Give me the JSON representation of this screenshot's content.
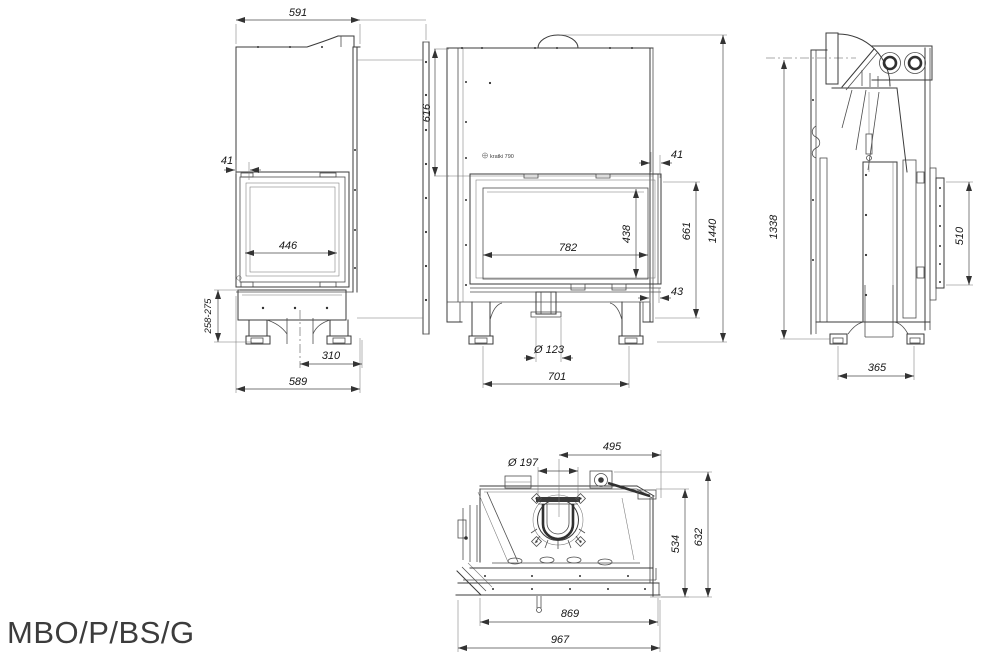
{
  "drawing": {
    "model": "MBO/P/BS/G",
    "brand_label": "kratki 790",
    "views": {
      "left_side": {
        "label": "left side view",
        "dims": {
          "depth_top": "591",
          "frame_offset": "41",
          "side_glass_width": "446",
          "base_height_range": "258-275",
          "inlet_offset": "310",
          "depth_bottom": "589"
        }
      },
      "front": {
        "label": "front view",
        "dims": {
          "hood_height": "616",
          "frame_offset": "41",
          "glass_width": "782",
          "glass_height": "438",
          "door_height": "661",
          "total_height": "1440",
          "frame_side": "43",
          "air_inlet_diameter": "Ø 123",
          "feet_spacing": "701"
        }
      },
      "right_side": {
        "label": "right side view",
        "dims": {
          "flue_axis_height": "1338",
          "handle_bar_length": "510",
          "feet_spacing": "365"
        }
      },
      "top": {
        "label": "top view",
        "dims": {
          "flue_offset": "495",
          "flue_diameter": "Ø 197",
          "body_depth": "534",
          "total_depth": "632",
          "body_width": "869",
          "total_width": "967"
        }
      }
    }
  }
}
